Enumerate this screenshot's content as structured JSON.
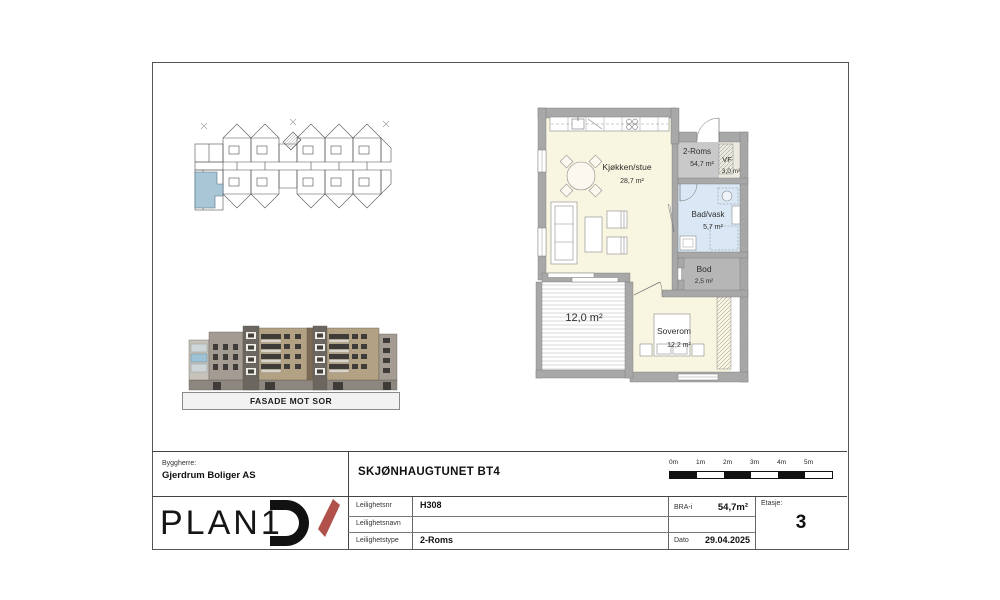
{
  "facade": {
    "caption": "FASADE MOT SOR"
  },
  "overview_plan": {
    "highlight_color": "#a9c6d6"
  },
  "floorplan": {
    "rooms": [
      {
        "name": "Kjøkken/stue",
        "area": "28,7 m²"
      },
      {
        "name": "2-Roms",
        "area": "54,7 m²"
      },
      {
        "name": "VF",
        "area": "3,0 m²"
      },
      {
        "name": "Bad/vask",
        "area": "5,7 m²"
      },
      {
        "name": "Bod",
        "area": "2,5 m²"
      },
      {
        "name": "Soverom",
        "area": "12,2 m²"
      }
    ],
    "terrace_area": "12,0 m²"
  },
  "scalebar": {
    "labels": [
      "0m",
      "1m",
      "2m",
      "3m",
      "4m",
      "5m"
    ]
  },
  "titleblock": {
    "byggherre_label": "Byggherre:",
    "byggherre_name": "Gjerdrum Boliger AS",
    "project_title": "SKJØNHAUGTUNET BT4",
    "rows": [
      {
        "label": "Leilighetsnr",
        "value": "H308"
      },
      {
        "label": "Leilighetsnavn",
        "value": ""
      },
      {
        "label": "Leilighetstype",
        "value": "2-Roms"
      }
    ],
    "bra": {
      "label": "BRA-i",
      "value": "54,7m²"
    },
    "dato": {
      "label": "Dato",
      "value": "29.04.2025"
    },
    "etasje": {
      "label": "Etasje:",
      "value": "3"
    },
    "logo": {
      "text": "PLAN1",
      "accent_color": "#b0514b"
    }
  }
}
